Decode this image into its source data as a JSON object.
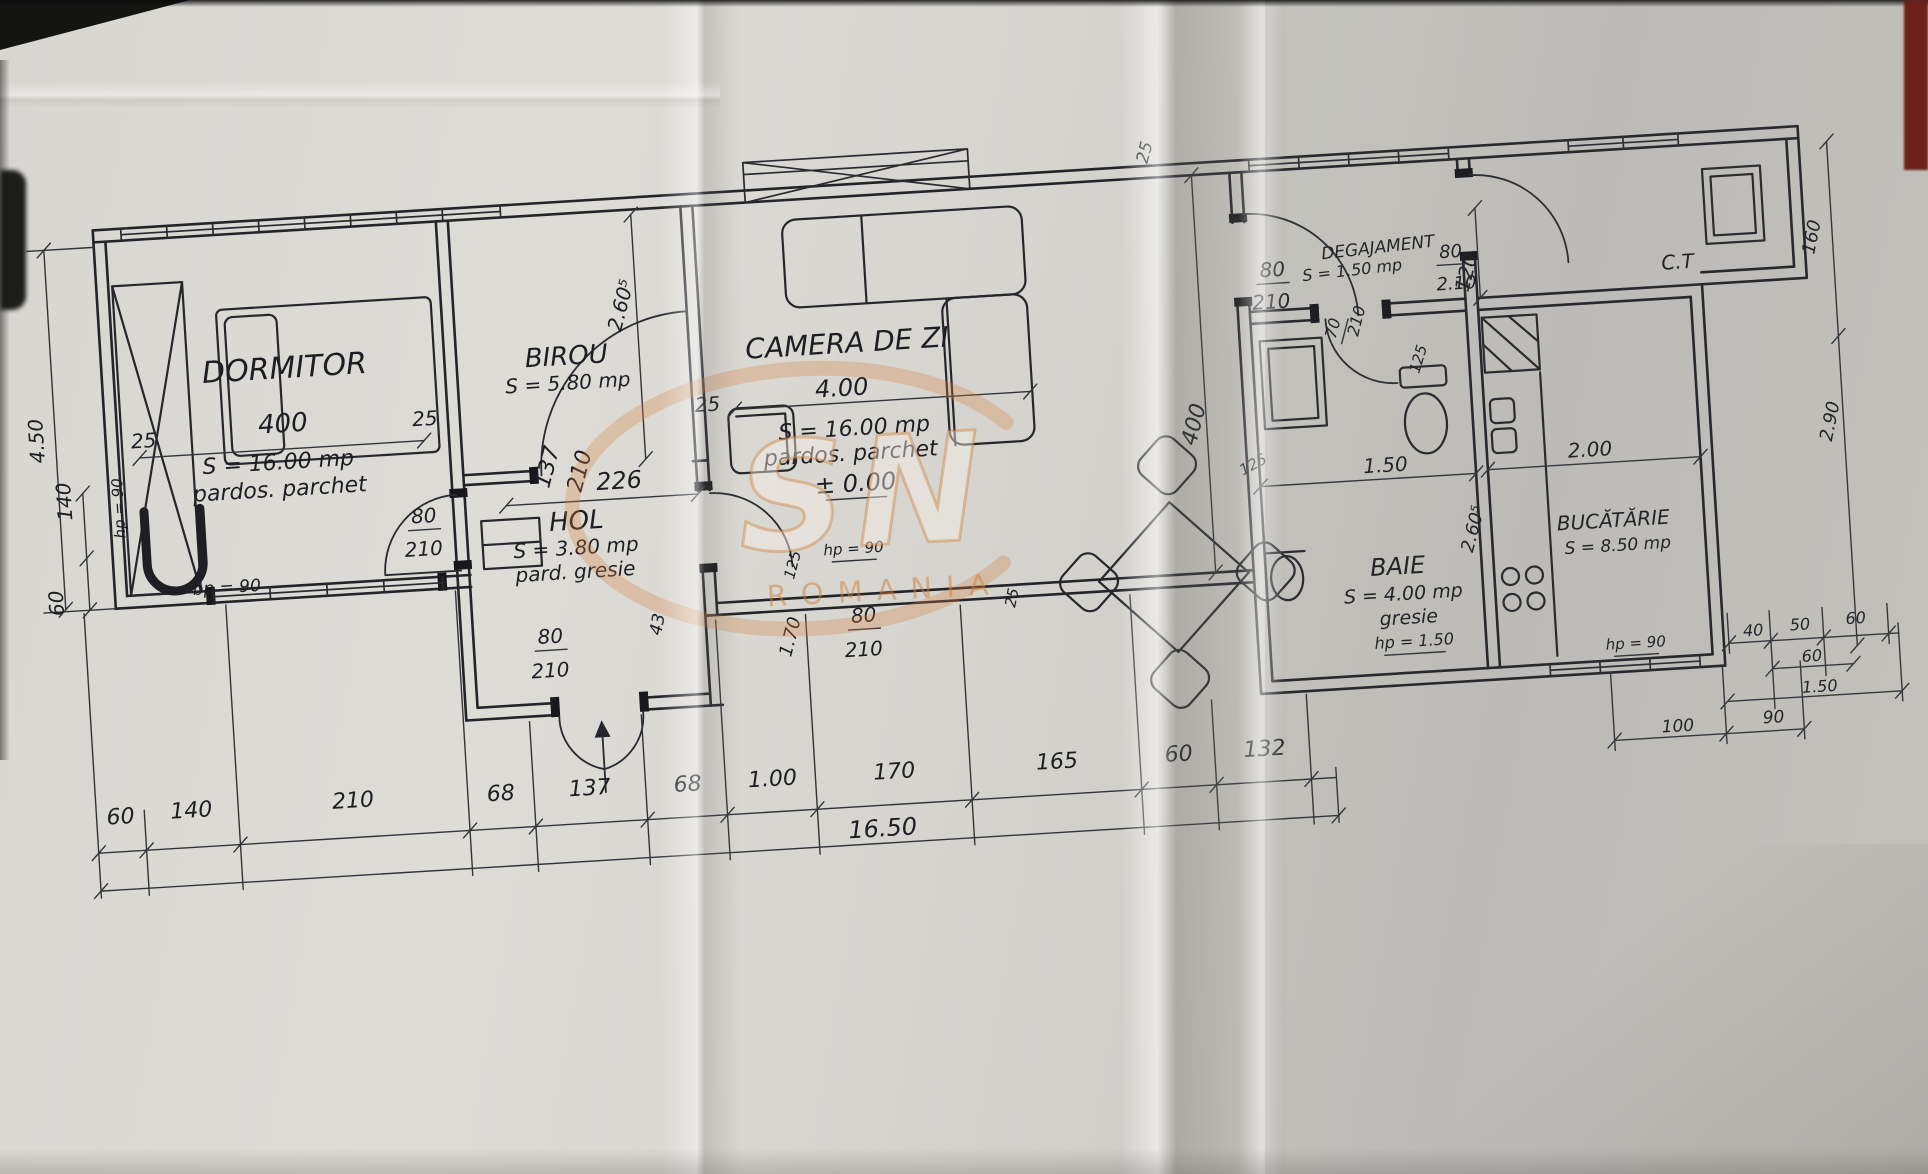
{
  "watermark": {
    "letters": "SN",
    "caption": "ROMANIA"
  },
  "labels": [
    {
      "id": "dormitor-name",
      "t": "DORMITOR",
      "x": 295,
      "y": 337,
      "s": 30,
      "r": 0,
      "u": false
    },
    {
      "id": "dormitor-width-dim",
      "t": "400",
      "x": 290,
      "y": 391,
      "s": 26,
      "r": 0,
      "u": false
    },
    {
      "id": "dormitor-area",
      "t": "S = 16.00 mp",
      "x": 283,
      "y": 428,
      "s": 22,
      "r": 0,
      "u": false
    },
    {
      "id": "dormitor-floor",
      "t": "pardos. parchet",
      "x": 283,
      "y": 455,
      "s": 22,
      "r": 0,
      "u": false
    },
    {
      "id": "wall-dim-25-a",
      "t": "25",
      "x": 150,
      "y": 398,
      "s": 20,
      "r": 0,
      "u": false
    },
    {
      "id": "wall-dim-25-b",
      "t": "25",
      "x": 432,
      "y": 393,
      "s": 20,
      "r": 0,
      "u": false
    },
    {
      "id": "hp-dormitor",
      "t": "hp = 90",
      "x": 126,
      "y": 457,
      "s": 15,
      "r": -90,
      "u": false
    },
    {
      "id": "bp-dormitor",
      "t": "bp = 90",
      "x": 224,
      "y": 548,
      "s": 17,
      "r": 0,
      "u": false
    },
    {
      "id": "dim-450",
      "t": "4.50",
      "x": 50,
      "y": 385,
      "s": 20,
      "r": -90,
      "u": false
    },
    {
      "id": "dim-140-left",
      "t": "140",
      "x": 74,
      "y": 447,
      "s": 20,
      "r": -90,
      "u": false
    },
    {
      "id": "dim-60-left",
      "t": "60",
      "x": 60,
      "y": 548,
      "s": 20,
      "r": -90,
      "u": false
    },
    {
      "id": "birou-name",
      "t": "BIROU",
      "x": 577,
      "y": 341,
      "s": 26,
      "r": 0,
      "u": false
    },
    {
      "id": "birou-area",
      "t": "S = 5.80 mp",
      "x": 577,
      "y": 366,
      "s": 20,
      "r": 0,
      "u": false
    },
    {
      "id": "dim-226",
      "t": "226",
      "x": 622,
      "y": 468,
      "s": 24,
      "r": 0,
      "u": false
    },
    {
      "id": "dim-137",
      "t": "137",
      "x": 558,
      "y": 444,
      "s": 22,
      "r": -72,
      "u": false
    },
    {
      "id": "dim-210-birou",
      "t": "210",
      "x": 590,
      "y": 450,
      "s": 22,
      "r": -72,
      "u": false
    },
    {
      "id": "dim-125-hol",
      "t": "125",
      "x": 795,
      "y": 556,
      "s": 15,
      "r": -72,
      "u": false
    },
    {
      "id": "dim-170",
      "t": "1.70",
      "x": 789,
      "y": 628,
      "s": 18,
      "r": -72,
      "u": false
    },
    {
      "id": "door-dormitor-80",
      "t": "80",
      "x": 425,
      "y": 490,
      "s": 20,
      "r": 0,
      "u": true
    },
    {
      "id": "door-dormitor-210",
      "t": "210",
      "x": 423,
      "y": 523,
      "s": 20,
      "r": 0,
      "u": false
    },
    {
      "id": "door-entry-80",
      "t": "80",
      "x": 544,
      "y": 618,
      "s": 20,
      "r": 0,
      "u": true
    },
    {
      "id": "door-entry-210",
      "t": "210",
      "x": 542,
      "y": 652,
      "s": 20,
      "r": 0,
      "u": false
    },
    {
      "id": "door-camera-80",
      "t": "80",
      "x": 858,
      "y": 616,
      "s": 20,
      "r": 0,
      "u": true
    },
    {
      "id": "door-camera-210",
      "t": "210",
      "x": 856,
      "y": 650,
      "s": 20,
      "r": 0,
      "u": false
    },
    {
      "id": "hol-name",
      "t": "HOL",
      "x": 577,
      "y": 506,
      "s": 26,
      "r": 0,
      "u": false
    },
    {
      "id": "hol-area",
      "t": "S = 3.80 mp",
      "x": 575,
      "y": 531,
      "s": 20,
      "r": 0,
      "u": false
    },
    {
      "id": "hol-floor",
      "t": "pard. gresie",
      "x": 573,
      "y": 555,
      "s": 20,
      "r": 0,
      "u": false
    },
    {
      "id": "dim-43",
      "t": "43",
      "x": 657,
      "y": 607,
      "s": 17,
      "r": -75,
      "u": false
    },
    {
      "id": "dim-2605-hol",
      "t": "2.60⁵",
      "x": 641,
      "y": 287,
      "s": 20,
      "r": -72,
      "u": false
    },
    {
      "id": "wall-dim-25-c",
      "t": "25",
      "x": 715,
      "y": 396,
      "s": 20,
      "r": 0,
      "u": false
    },
    {
      "id": "camera-name",
      "t": "CAMERA DE ZI",
      "x": 858,
      "y": 346,
      "s": 28,
      "r": 0,
      "u": false
    },
    {
      "id": "camera-width-dim",
      "t": "4.00",
      "x": 850,
      "y": 389,
      "s": 24,
      "r": 0,
      "u": false
    },
    {
      "id": "camera-area",
      "t": "S = 16.00 mp",
      "x": 860,
      "y": 429,
      "s": 22,
      "r": 0,
      "u": false
    },
    {
      "id": "camera-floor",
      "t": "pardos. parchet",
      "x": 855,
      "y": 454,
      "s": 22,
      "r": 0,
      "u": false
    },
    {
      "id": "camera-level",
      "t": "± 0.00",
      "x": 858,
      "y": 485,
      "s": 24,
      "r": 0,
      "u": true
    },
    {
      "id": "hp-camera",
      "t": "hp = 90",
      "x": 852,
      "y": 547,
      "s": 15,
      "r": 0,
      "u": true
    },
    {
      "id": "dim-25-top",
      "t": "25",
      "x": 1172,
      "y": 166,
      "s": 17,
      "r": -72,
      "u": false
    },
    {
      "id": "dim-400-vert",
      "t": "400",
      "x": 1206,
      "y": 441,
      "s": 22,
      "r": -72,
      "u": false
    },
    {
      "id": "dim-125-camera",
      "t": "125",
      "x": 1258,
      "y": 487,
      "s": 15,
      "r": -25,
      "u": false
    },
    {
      "id": "dim-25-step",
      "t": "25",
      "x": 1012,
      "y": 602,
      "s": 15,
      "r": -75,
      "u": false
    },
    {
      "id": "degajament-name",
      "t": "DEGAJAMENT",
      "x": 1394,
      "y": 279,
      "s": 17,
      "r": -3,
      "u": false
    },
    {
      "id": "degajament-area",
      "t": "S = 1.50 mp",
      "x": 1367,
      "y": 300,
      "s": 16,
      "r": -3,
      "u": false
    },
    {
      "id": "door-degajament-80",
      "t": "80",
      "x": 1287,
      "y": 296,
      "s": 20,
      "r": 0,
      "u": true
    },
    {
      "id": "door-degajament-210",
      "t": "210",
      "x": 1284,
      "y": 328,
      "s": 20,
      "r": 0,
      "u": false
    },
    {
      "id": "dim-120",
      "t": "120",
      "x": 1487,
      "y": 306,
      "s": 20,
      "r": -72,
      "u": false
    },
    {
      "id": "door-ct-80",
      "t": "80",
      "x": 1466,
      "y": 288,
      "s": 18,
      "r": 0,
      "u": true
    },
    {
      "id": "door-ct-210",
      "t": "2.10",
      "x": 1470,
      "y": 320,
      "s": 18,
      "r": 0,
      "u": false
    },
    {
      "id": "door-baie-70",
      "t": "70",
      "x": 1349,
      "y": 353,
      "s": 16,
      "r": -72,
      "u": true
    },
    {
      "id": "door-baie-210",
      "t": "210",
      "x": 1373,
      "y": 347,
      "s": 16,
      "r": -72,
      "u": false
    },
    {
      "id": "baie-name",
      "t": "BAIE",
      "x": 1394,
      "y": 601,
      "s": 24,
      "r": 0,
      "u": false
    },
    {
      "id": "baie-area",
      "t": "S = 4.00 mp",
      "x": 1398,
      "y": 627,
      "s": 19,
      "r": 0,
      "u": false
    },
    {
      "id": "baie-floor",
      "t": "gresie",
      "x": 1402,
      "y": 651,
      "s": 19,
      "r": 0,
      "u": false
    },
    {
      "id": "hp-baie",
      "t": "hp = 1.50",
      "x": 1406,
      "y": 674,
      "s": 16,
      "r": 0,
      "u": true
    },
    {
      "id": "dim-150-baie",
      "t": "1.50",
      "x": 1388,
      "y": 498,
      "s": 20,
      "r": 0,
      "u": false
    },
    {
      "id": "dim-125-baie",
      "t": "125",
      "x": 1432,
      "y": 389,
      "s": 15,
      "r": -70,
      "u": false
    },
    {
      "id": "dim-200-kitchen",
      "t": "2.00",
      "x": 1593,
      "y": 495,
      "s": 20,
      "r": 0,
      "u": false
    },
    {
      "id": "dim-2605-kitchen",
      "t": "2.60⁵",
      "x": 1477,
      "y": 562,
      "s": 18,
      "r": -72,
      "u": false
    },
    {
      "id": "bucatarie-name",
      "t": "BUCĂTĂRIE",
      "x": 1612,
      "y": 567,
      "s": 20,
      "r": 0,
      "u": false
    },
    {
      "id": "bucatarie-area",
      "t": "S = 8.50 mp",
      "x": 1615,
      "y": 591,
      "s": 17,
      "r": 0,
      "u": false
    },
    {
      "id": "hp-bucatarie",
      "t": "hp = 90",
      "x": 1627,
      "y": 689,
      "s": 15,
      "r": 0,
      "u": true
    },
    {
      "id": "ct-name",
      "t": "C.T",
      "x": 1692,
      "y": 313,
      "s": 20,
      "r": 0,
      "u": false
    },
    {
      "id": "dim-160",
      "t": "160",
      "x": 1833,
      "y": 291,
      "s": 18,
      "r": -75,
      "u": false
    },
    {
      "id": "dim-290",
      "t": "2.90",
      "x": 1840,
      "y": 476,
      "s": 18,
      "r": -75,
      "u": false
    },
    {
      "id": "dim-40",
      "t": "40",
      "x": 1745,
      "y": 684,
      "s": 16,
      "r": 0,
      "u": false
    },
    {
      "id": "dim-50",
      "t": "50",
      "x": 1792,
      "y": 681,
      "s": 16,
      "r": 0,
      "u": false
    },
    {
      "id": "dim-60-r1",
      "t": "60",
      "x": 1848,
      "y": 678,
      "s": 16,
      "r": 0,
      "u": false
    },
    {
      "id": "dim-60-r2",
      "t": "60",
      "x": 1802,
      "y": 713,
      "s": 16,
      "r": 0,
      "u": false
    },
    {
      "id": "dim-150-r",
      "t": "1.50",
      "x": 1808,
      "y": 744,
      "s": 16,
      "r": 0,
      "u": false
    },
    {
      "id": "dim-100",
      "t": "100",
      "x": 1664,
      "y": 775,
      "s": 17,
      "r": 0,
      "u": false
    },
    {
      "id": "dim-90",
      "t": "90",
      "x": 1760,
      "y": 772,
      "s": 17,
      "r": 0,
      "u": false
    },
    {
      "id": "bottom-60a",
      "t": "60",
      "x": 104,
      "y": 772,
      "s": 22,
      "r": 0,
      "u": false
    },
    {
      "id": "bottom-140",
      "t": "140",
      "x": 175,
      "y": 770,
      "s": 22,
      "r": 0,
      "u": false
    },
    {
      "id": "bottom-210",
      "t": "210",
      "x": 337,
      "y": 770,
      "s": 22,
      "r": 0,
      "u": false
    },
    {
      "id": "bottom-68a",
      "t": "68",
      "x": 485,
      "y": 772,
      "s": 22,
      "r": 0,
      "u": false
    },
    {
      "id": "bottom-137",
      "t": "137",
      "x": 574,
      "y": 772,
      "s": 22,
      "r": 0,
      "u": false
    },
    {
      "id": "bottom-68b",
      "t": "68",
      "x": 672,
      "y": 774,
      "s": 22,
      "r": 0,
      "u": false
    },
    {
      "id": "bottom-100",
      "t": "1.00",
      "x": 757,
      "y": 774,
      "s": 22,
      "r": 0,
      "u": false
    },
    {
      "id": "bottom-170",
      "t": "170",
      "x": 879,
      "y": 774,
      "s": 22,
      "r": 0,
      "u": false
    },
    {
      "id": "bottom-165",
      "t": "165",
      "x": 1042,
      "y": 774,
      "s": 22,
      "r": 0,
      "u": false
    },
    {
      "id": "bottom-60b",
      "t": "60",
      "x": 1164,
      "y": 774,
      "s": 22,
      "r": 0,
      "u": false
    },
    {
      "id": "bottom-132",
      "t": "132",
      "x": 1250,
      "y": 774,
      "s": 22,
      "r": 0,
      "u": false
    },
    {
      "id": "bottom-total",
      "t": "16.50",
      "x": 864,
      "y": 831,
      "s": 24,
      "r": 0,
      "u": false
    }
  ]
}
